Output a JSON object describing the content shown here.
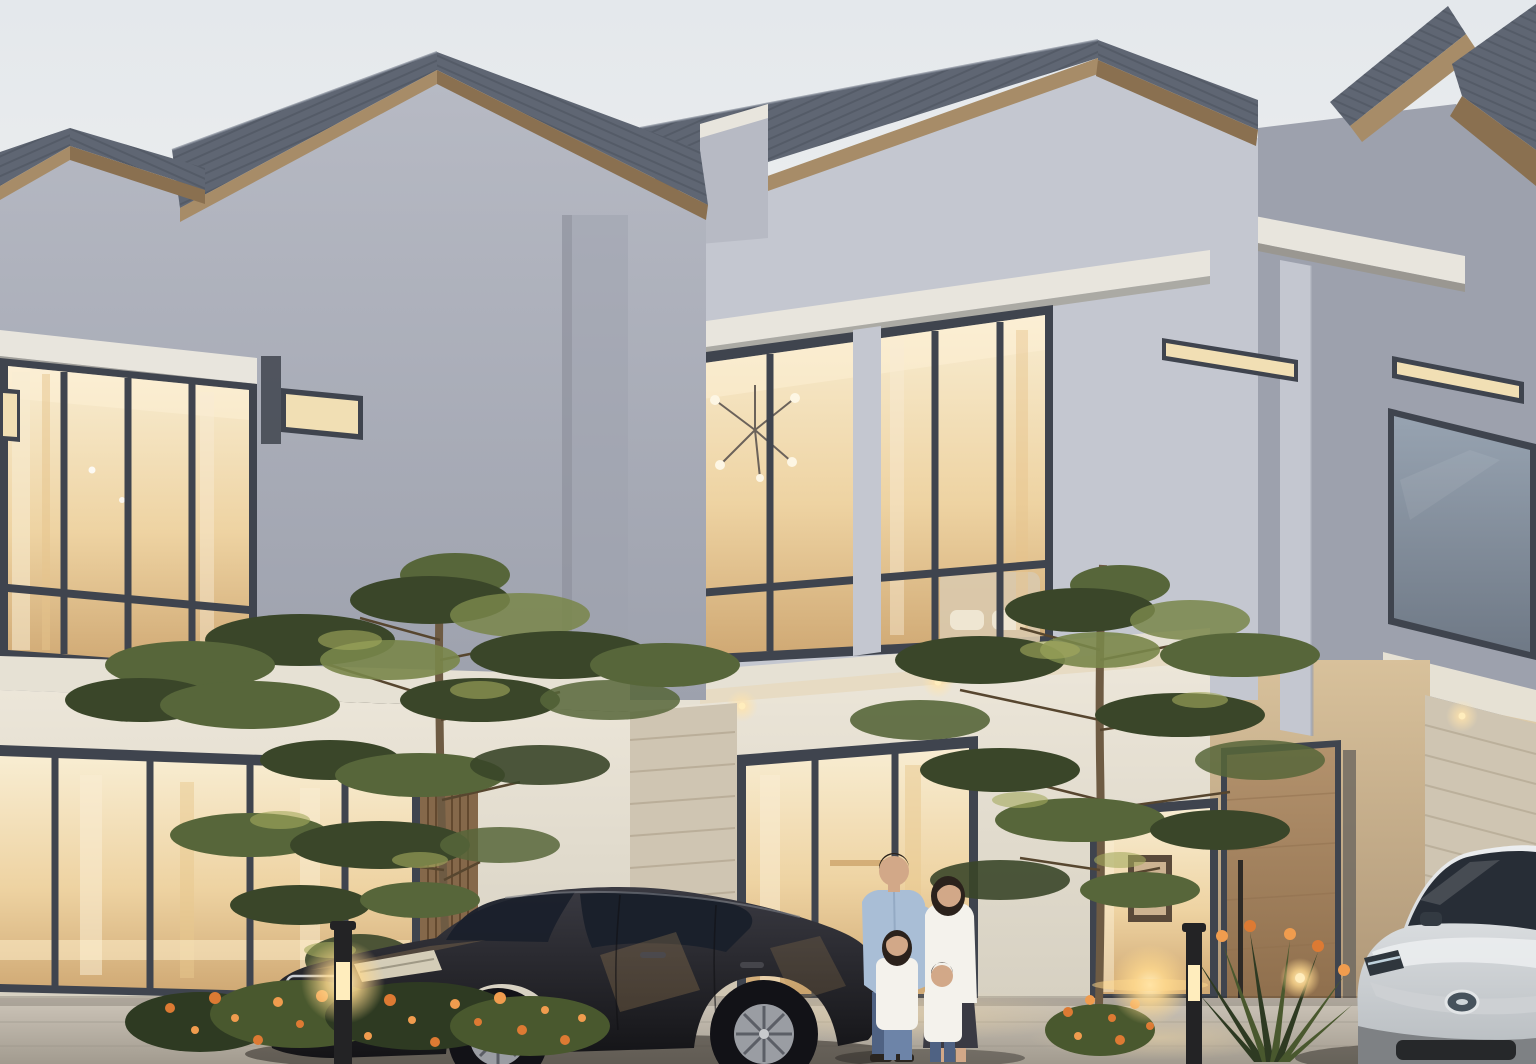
{
  "meta": {
    "title": "Modern two-storey townhouses at dusk; family of four standing in driveway between a dark sedan and a silver SUV",
    "scene_type": "photorealistic architectural rendering",
    "time_of_day": "dusk"
  },
  "palette": {
    "sky_top": "#e4e8ec",
    "sky_bottom": "#f4f4f1",
    "roof": "#5f6673",
    "roof_dark": "#474d59",
    "roof_light": "#848b98",
    "fascia": "#a78c68",
    "fascia_dark": "#8a7050",
    "wall_upper": "#b7bac4",
    "wall_upper_dark": "#9da1ad",
    "wall_gable": "#c4c7d0",
    "beam": "#e8e5dd",
    "beam_shadow": "#97917f",
    "frame": "#3f444e",
    "glow_top": "#f8edd2",
    "glow_mid": "#eed3a2",
    "glow_deep": "#cfa873",
    "glow_soft": "#f1dfb4",
    "win_dark_top": "#97a3b1",
    "win_dark_bot": "#6f7986",
    "slab": "#e6e1d4",
    "wall_ground": "#ece6d9",
    "wall_ground_dark": "#d6d0c1",
    "stone": "#cfc5b2",
    "stone_line": "#ab9f88",
    "wood_slat": "#85684a",
    "wood_slat_line": "#63492f",
    "wood_door": "#b3926d",
    "wood_door_dark": "#8f6f4d",
    "porch_top": "#d8c19b",
    "porch_bot": "#ae9677",
    "drive_top": "#cdc5b9",
    "drive_bot": "#a29b8f",
    "pool": "#e9d2a4",
    "shadow": "#1f1c18",
    "tree_dark": "#3a4629",
    "tree_mid": "#57663a",
    "tree_light": "#79864a",
    "tree_glow": "#a3aa5e",
    "trunk": "#6e5b43",
    "branch": "#57462f",
    "car_top": "#3a3a42",
    "car_bot": "#141417",
    "car_glass": "#1a202b",
    "chrome": "#c9ccd2",
    "car_reflect": "#b08d58",
    "suv_top": "#eceef0",
    "suv_bot": "#b6bbbf",
    "suv_glass": "#272d36",
    "suv_trim": "#cdd0d3",
    "skin": "#d2a888",
    "hair": "#2b221c",
    "shirt_man": "#a9bed6",
    "jeans": "#4f6283",
    "jeans_light": "#6d84a8",
    "white_cloth": "#f4f2ec",
    "skirt": "#3a3a43",
    "flower": "#dd7a33",
    "flower_light": "#f09c4e",
    "leaf_dark": "#2e3a22",
    "leaf_mid": "#49582e",
    "lamp_glow": "#ffd98e",
    "lamp_core": "#ffedbd",
    "lamp_post": "#232325",
    "downlight": "#ffe3ac"
  },
  "scene": {
    "buildings": {
      "count": 3,
      "storeys": 2,
      "style": "modern gable-roof townhouses",
      "roof": "dark slate tiles with timber fascia",
      "upper_windows_lit": true,
      "slit_windows_lit": true,
      "right_unit_upper_window": "dark / unlit",
      "ground_floor": "glass doors with warm light, travertine piers, timber slat panel, timber entry door"
    },
    "vehicles": [
      {
        "type": "sedan",
        "color": "dark grey",
        "emblem": "three-pointed-star",
        "position": "center-left of driveway"
      },
      {
        "type": "suv",
        "color": "silver",
        "emblem": "oval-badge",
        "position": "far right, partially cropped"
      }
    ],
    "people": [
      {
        "name": "man",
        "clothing": "light blue shirt, jeans"
      },
      {
        "name": "woman",
        "clothing": "white top, dark skirt"
      },
      {
        "name": "girl",
        "clothing": "white top, jeans"
      },
      {
        "name": "boy",
        "clothing": "white top, jeans"
      }
    ],
    "landscaping": {
      "trees": 2,
      "hedge": "low hedge with orange flowers (left)",
      "shrubs": "spiky-leaf shrubs with orange blooms (right)"
    },
    "lighting": {
      "bollard_lights": 2,
      "garden_light": 1,
      "soffit_downlights": 4,
      "interiors": "warm glow"
    }
  }
}
